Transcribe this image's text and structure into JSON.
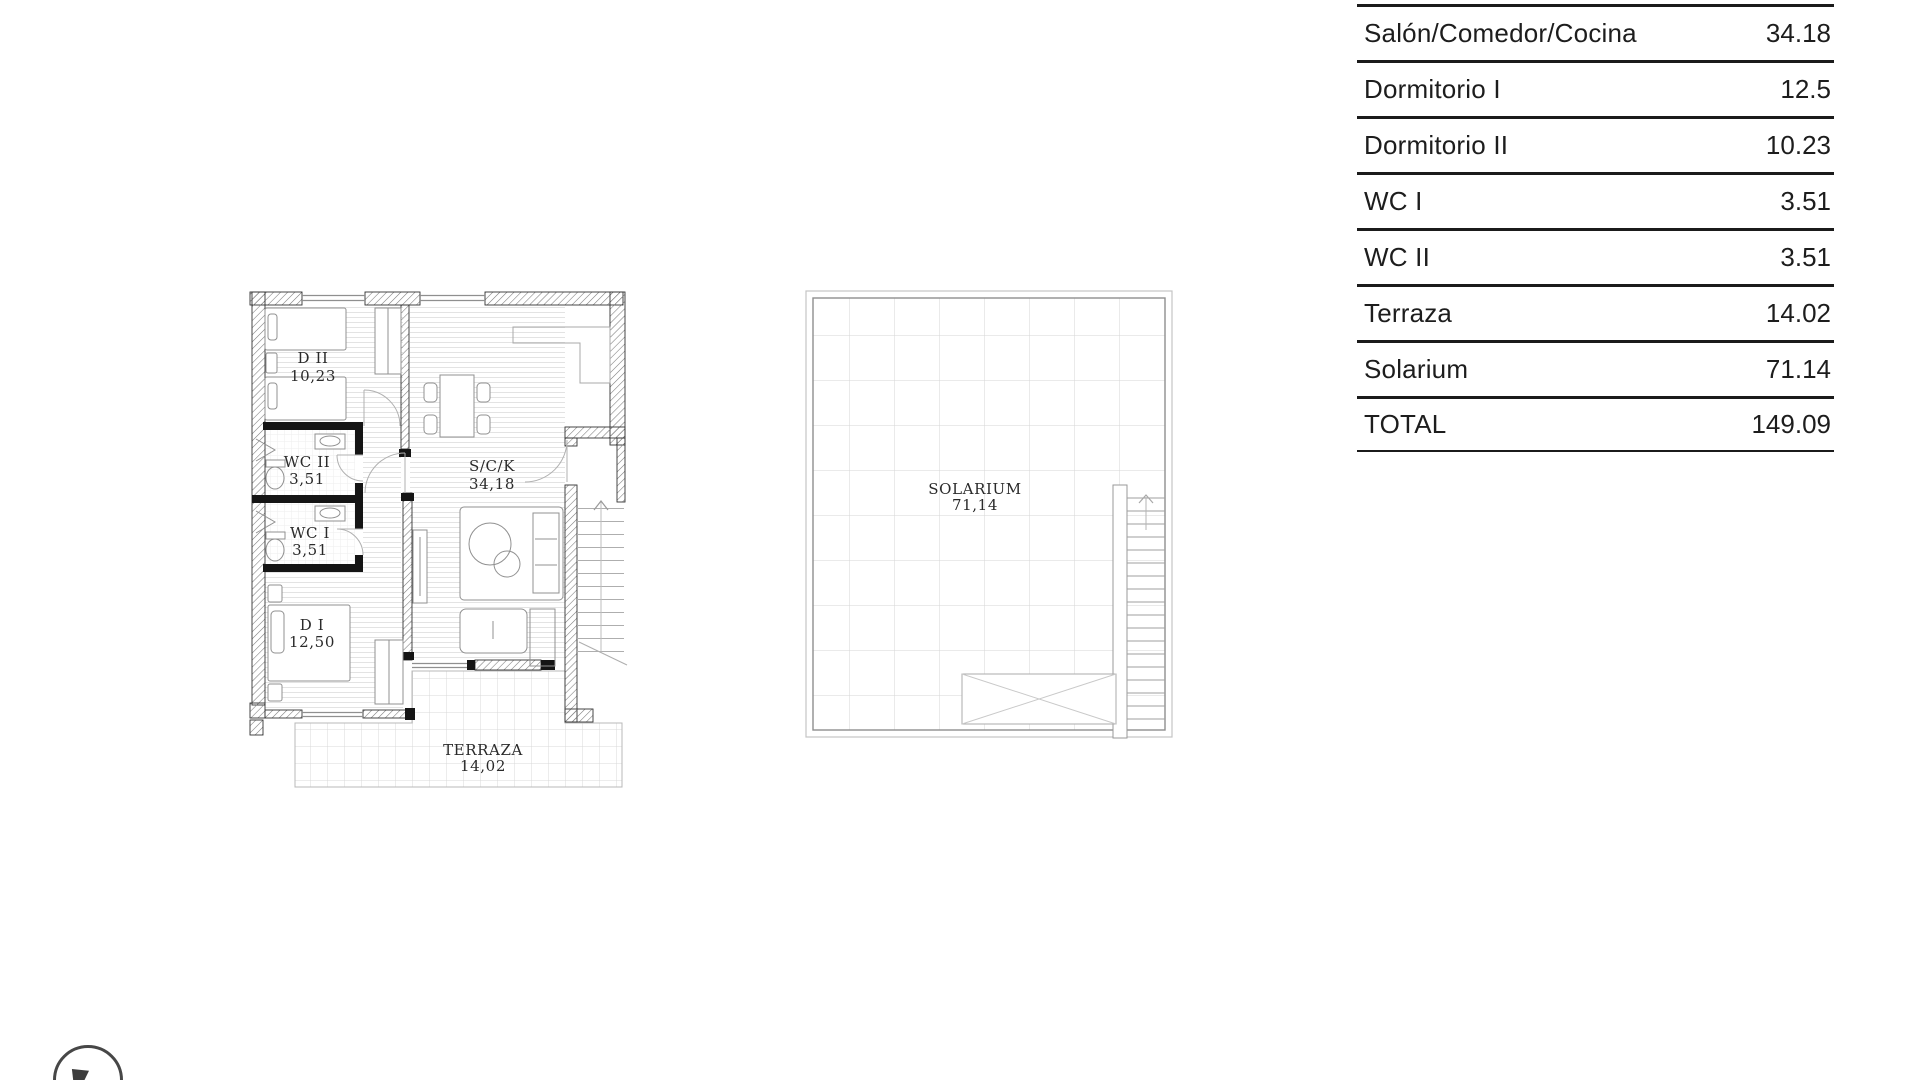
{
  "table": {
    "rows": [
      {
        "label": "Salón/Comedor/Cocina",
        "value": "34.18"
      },
      {
        "label": "Dormitorio I",
        "value": "12.5"
      },
      {
        "label": "Dormitorio II",
        "value": "10.23"
      },
      {
        "label": "WC I",
        "value": "3.51"
      },
      {
        "label": "WC II",
        "value": "3.51"
      },
      {
        "label": "Terraza",
        "value": "14.02"
      },
      {
        "label": "Solarium",
        "value": "71.14"
      },
      {
        "label": "TOTAL",
        "value": "149.09"
      }
    ]
  },
  "floorplan": {
    "rooms": {
      "d2": {
        "name": "D II",
        "area": "10,23"
      },
      "wc2": {
        "name": "WC II",
        "area": "3,51"
      },
      "wc1": {
        "name": "WC I",
        "area": "3,51"
      },
      "d1": {
        "name": "D I",
        "area": "12,50"
      },
      "sck": {
        "name": "S/C/K",
        "area": "34,18"
      },
      "terraza": {
        "name": "TERRAZA",
        "area": "14,02"
      }
    }
  },
  "solarium": {
    "name": "SOLARIUM",
    "area": "71,14"
  },
  "colors": {
    "table_line": "#1b1b1b",
    "text": "#1d1d1d",
    "wall_outline": "#333333",
    "interior_wall": "#151515",
    "floor_hatch": "#e3e3e3",
    "tile_grid": "#d9d9d9",
    "furniture": "#909090",
    "stair_line": "#aeaeae"
  }
}
